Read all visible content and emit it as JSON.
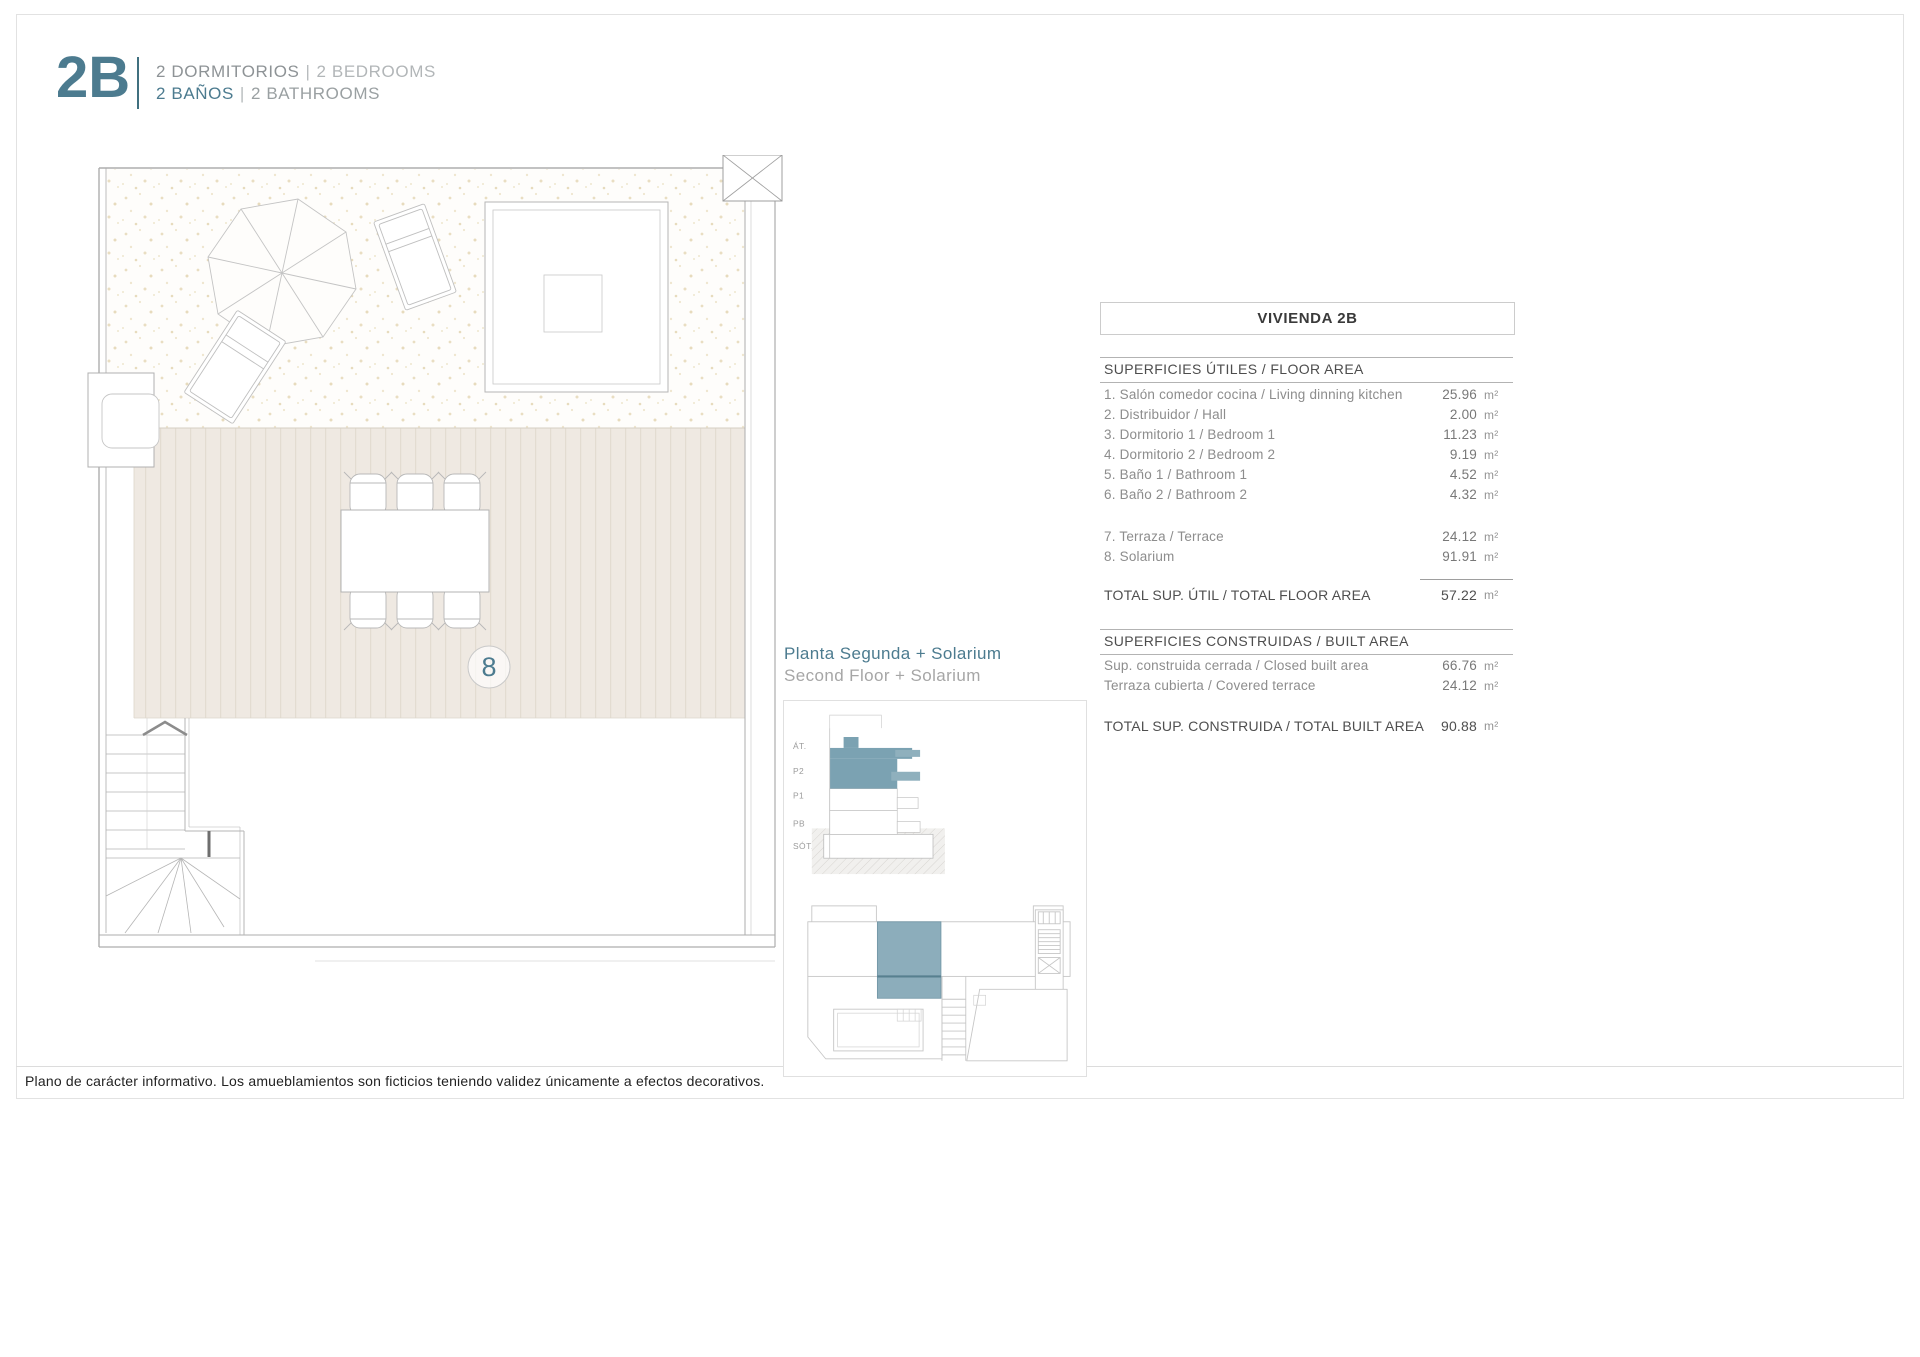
{
  "header": {
    "unit_code": "2B",
    "bedrooms_es": "2 DORMITORIOS",
    "bedrooms_en": "2 BEDROOMS",
    "bathrooms_es": "2 BAÑOS",
    "bathrooms_en": "2 BATHROOMS",
    "separator": "|"
  },
  "plan": {
    "zone_label": "8"
  },
  "location": {
    "title_es": "Planta Segunda + Solarium",
    "title_en": "Second Floor + Solarium",
    "section_levels": [
      "ÁT.",
      "P2",
      "P1",
      "PB",
      "SÓT."
    ]
  },
  "area_table": {
    "title": "VIVIENDA 2B",
    "unit": "m²",
    "floor_area": {
      "header": "SUPERFICIES ÚTILES / FLOOR AREA",
      "rows": [
        {
          "label": "1. Salón comedor cocina / Living dinning kitchen",
          "value": "25.96",
          "unit": "m²"
        },
        {
          "label": "2. Distribuidor / Hall",
          "value": "2.00",
          "unit": "m²"
        },
        {
          "label": "3. Dormitorio 1 / Bedroom 1",
          "value": "11.23",
          "unit": "m²"
        },
        {
          "label": "4. Dormitorio 2 / Bedroom 2",
          "value": "9.19",
          "unit": "m²"
        },
        {
          "label": "5. Baño 1 / Bathroom 1",
          "value": "4.52",
          "unit": "m²"
        },
        {
          "label": "6. Baño 2 / Bathroom 2",
          "value": "4.32",
          "unit": "m²"
        }
      ],
      "extra_rows": [
        {
          "label": "7. Terraza / Terrace",
          "value": "24.12",
          "unit": "m²"
        },
        {
          "label": "8. Solarium",
          "value": "91.91",
          "unit": "m²"
        }
      ],
      "total": {
        "label": "TOTAL SUP. ÚTIL / TOTAL FLOOR AREA",
        "value": "57.22",
        "unit": "m²"
      }
    },
    "built_area": {
      "header": "SUPERFICIES CONSTRUIDAS / BUILT AREA",
      "rows": [
        {
          "label": "Sup. construida cerrada / Closed built area",
          "value": "66.76",
          "unit": "m²"
        },
        {
          "label": "Terraza cubierta / Covered terrace",
          "value": "24.12",
          "unit": "m²"
        }
      ],
      "total": {
        "label": "TOTAL SUP. CONSTRUIDA /  TOTAL BUILT AREA",
        "value": "90.88",
        "unit": "m²"
      }
    }
  },
  "footer": {
    "disclaimer": "Plano de carácter informativo. Los amueblamientos son ficticios teniendo validez únicamente a efectos decorativos."
  },
  "colors": {
    "accent": "#4c7b8f",
    "highlight": "#8cadbb",
    "deck": "#efe9e2"
  }
}
